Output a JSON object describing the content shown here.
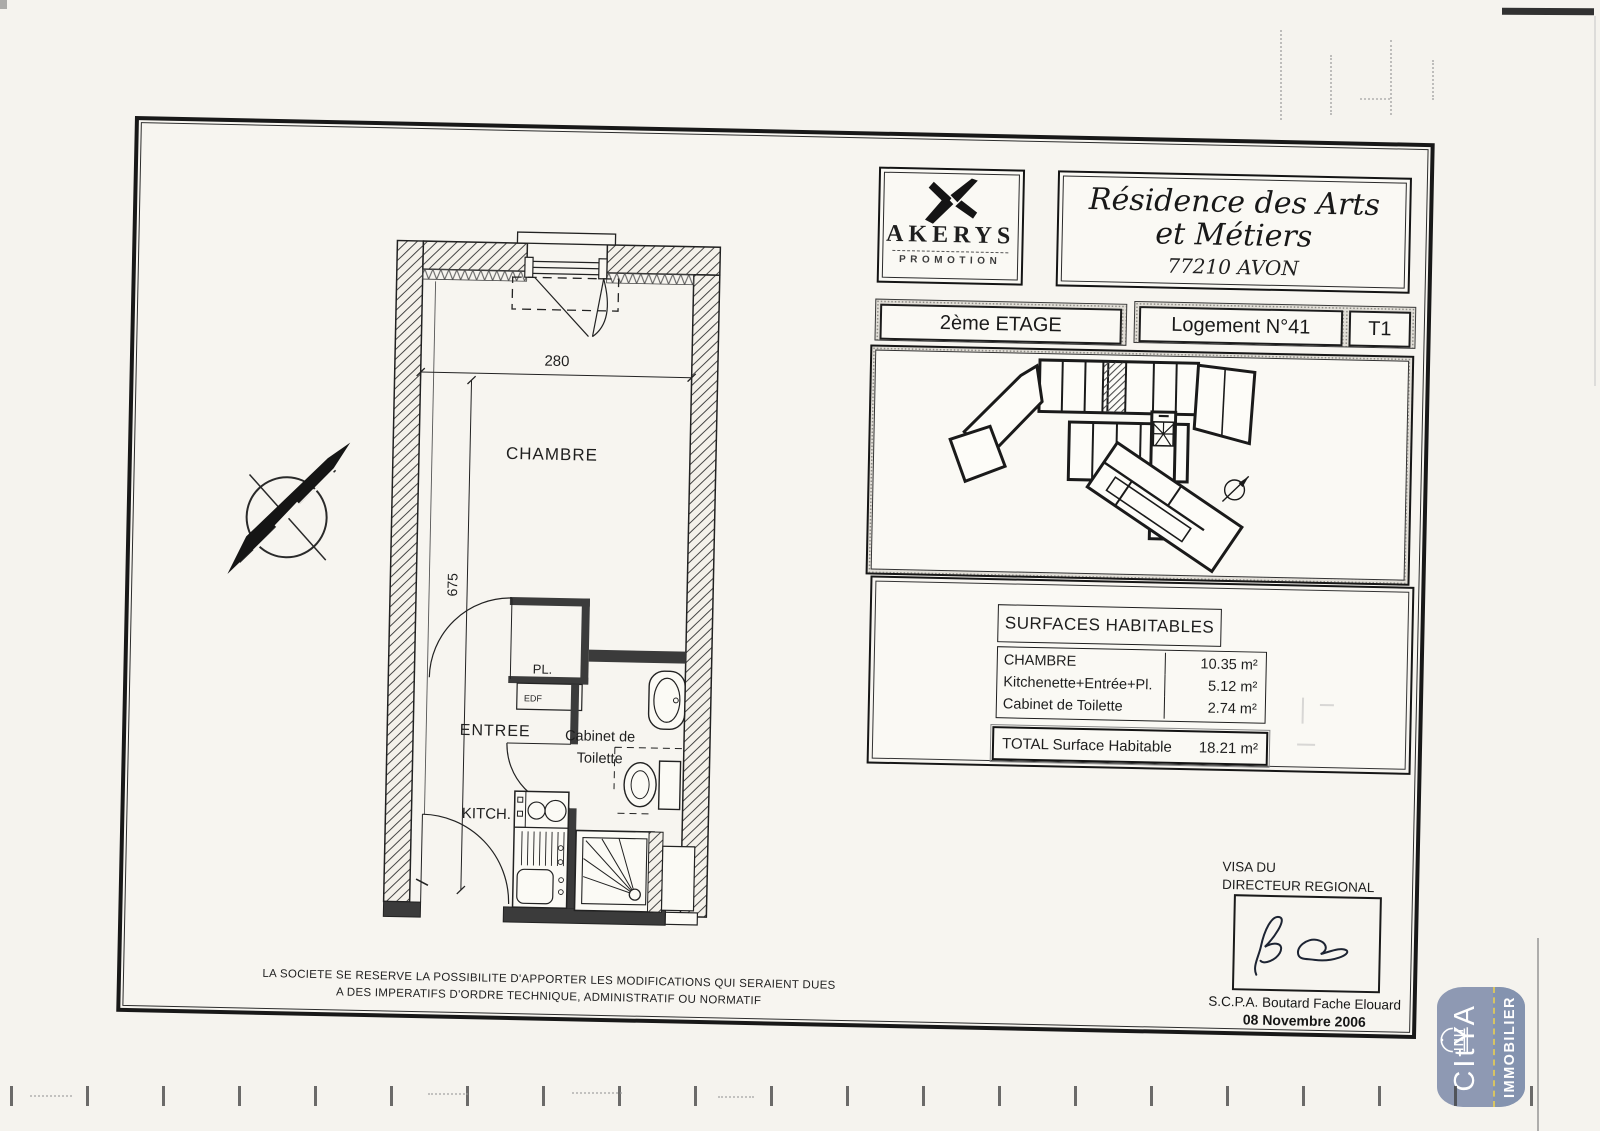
{
  "branding": {
    "akerys": {
      "name": "AKERYS",
      "subtitle": "PROMOTION"
    },
    "residence": {
      "line1": "Résidence des Arts",
      "line2": "et Métiers",
      "city": "77210 AVON"
    }
  },
  "unit_bar": {
    "floor": "2ème ETAGE",
    "unit": "Logement N°41",
    "type": "T1"
  },
  "floor_plan": {
    "labels": {
      "chambre": "CHAMBRE",
      "entree": "ENTREE",
      "kitchen": "KITCH.",
      "closet": "PL.",
      "edf": "EDF",
      "toilet_line1": "Cabinet de",
      "toilet_line2": "Toilette"
    },
    "dimensions": {
      "width_cm": "280",
      "height_cm": "675"
    }
  },
  "surfaces_table": {
    "title": "SURFACES HABITABLES",
    "rows": [
      {
        "label": "CHAMBRE",
        "value": "10.35 m²"
      },
      {
        "label": "Kitchenette+Entrée+Pl.",
        "value": "5.12 m²"
      },
      {
        "label": "Cabinet de Toilette",
        "value": "2.74 m²"
      }
    ],
    "total": {
      "label": "TOTAL Surface Habitable",
      "value": "18.21 m²"
    }
  },
  "disclaimer": {
    "line1": "LA SOCIETE SE RESERVE LA POSSIBILITE D'APPORTER LES MODIFICATIONS QUI SERAIENT DUES",
    "line2": "A DES IMPERATIFS D'ORDRE TECHNIQUE, ADMINISTRATIF OU NORMATIF"
  },
  "visa": {
    "title_line1": "VISA DU",
    "title_line2": "DIRECTEUR REGIONAL",
    "signatory": "S.C.P.A. Boutard Fache Elouard",
    "date": "08 Novembre 2006"
  },
  "watermark": {
    "brand": "CItYA",
    "division": "IMMOBILIER",
    "bg_color": "#8a96b1",
    "division_bg_color": "#8090ad",
    "accent_color": "#d6c35e"
  }
}
